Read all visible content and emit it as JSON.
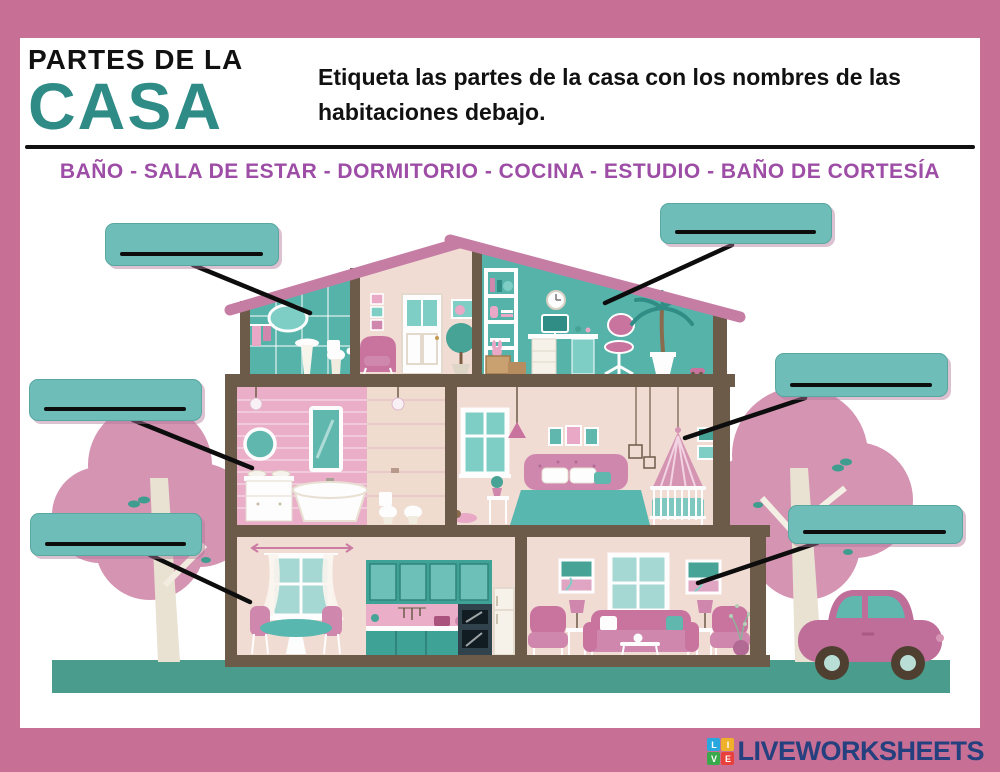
{
  "colors": {
    "frame_pink": "#c76f94",
    "title_teal": "#2e8b85",
    "word_bank_purple": "#9d4da5",
    "answer_box_teal": "#6ebdb8",
    "ground_teal": "#4a9c8d",
    "roof_pink": "#c57da4",
    "beam_brown": "#6d5b49"
  },
  "header": {
    "title_line1": "PARTES DE LA",
    "title_line2": "CASA",
    "instructions": "Etiqueta las partes de la casa con los nombres de las habitaciones debajo."
  },
  "word_bank": {
    "text": "BAÑO - SALA DE ESTAR - DORMITORIO - COCINA - ESTUDIO - BAÑO DE CORTESÍA",
    "items": [
      "BAÑO",
      "SALA DE ESTAR",
      "DORMITORIO",
      "COCINA",
      "ESTUDIO",
      "BAÑO DE CORTESÍA"
    ]
  },
  "answer_boxes": [
    {
      "target": "attic-bathroom",
      "value": ""
    },
    {
      "target": "study",
      "value": ""
    },
    {
      "target": "bedroom",
      "value": ""
    },
    {
      "target": "bathroom",
      "value": ""
    },
    {
      "target": "kitchen",
      "value": ""
    },
    {
      "target": "living-room",
      "value": ""
    }
  ],
  "footer_logo": {
    "text": "LIVEWORKSHEETS",
    "text_color": "#24407e",
    "tiles": [
      {
        "letter": "L",
        "color": "#29a8e0"
      },
      {
        "letter": "I",
        "color": "#efb02a"
      },
      {
        "letter": "V",
        "color": "#3aa94b"
      },
      {
        "letter": "E",
        "color": "#e8403a"
      }
    ]
  }
}
